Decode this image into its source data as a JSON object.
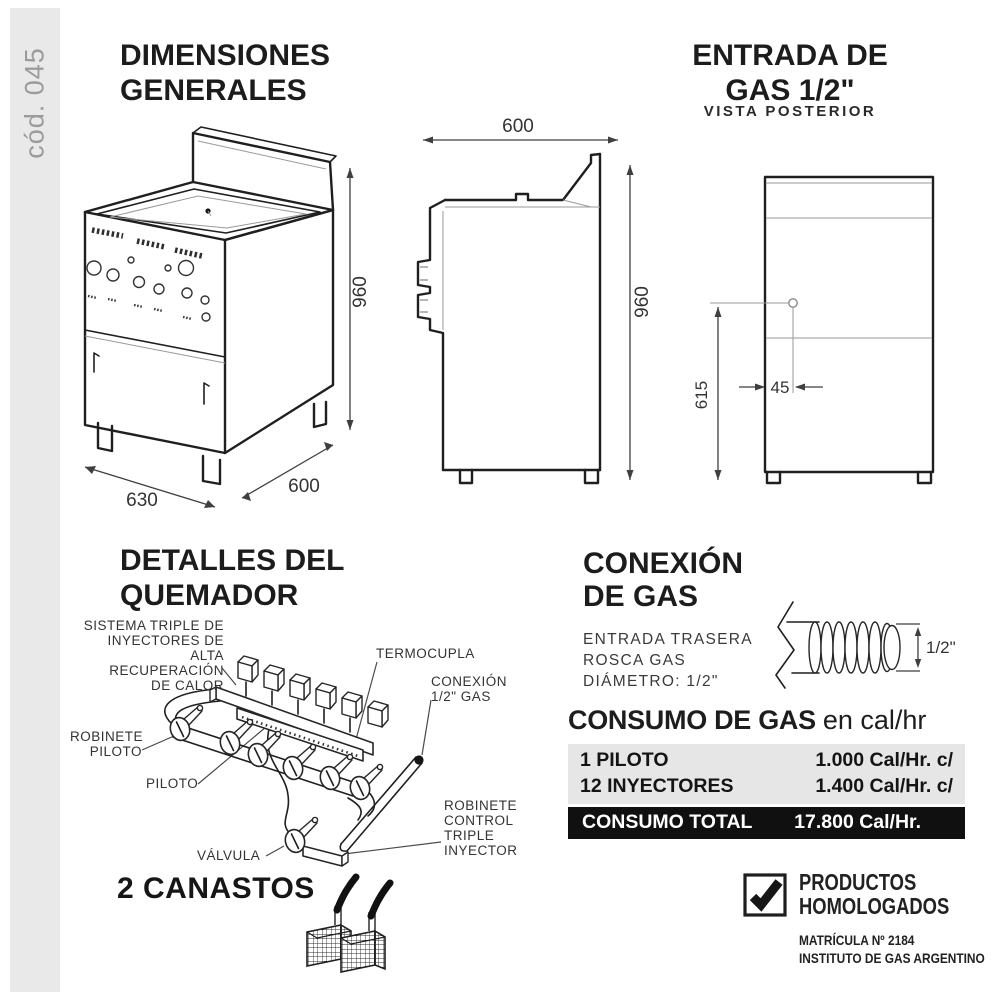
{
  "colors": {
    "sidebar_bg": "#e9e9e9",
    "sidebar_text": "#9b9b9b",
    "line_art": "#1f1f1f",
    "table_gray": "#e6e6e6",
    "table_black": "#101010"
  },
  "sidebar": {
    "code": "cód. 045"
  },
  "dimensiones": {
    "title_line1": "DIMENSIONES",
    "title_line2": "GENERALES",
    "iso_width": "630",
    "iso_depth": "600",
    "iso_height": "960",
    "side_width": "600",
    "side_height": "960"
  },
  "entrada": {
    "title_line1": "ENTRADA DE",
    "title_line2": "GAS 1/2\"",
    "subtitle": "VISTA POSTERIOR",
    "height_dim": "615",
    "offset_dim": "45"
  },
  "quemador": {
    "title_line1": "DETALLES DEL",
    "title_line2": "QUEMADOR",
    "labels": {
      "sistema": "SISTEMA TRIPLE DE\nINYECTORES DE\nALTA RECUPERACIÓN\nDE CALOR",
      "termocupla": "TERMOCUPLA",
      "conexion": "CONEXIÓN\n1/2\" GAS",
      "robinete_piloto": "ROBINETE\nPILOTO",
      "piloto": "PILOTO",
      "valvula": "VÁLVULA",
      "robinete_control": "ROBINETE\nCONTROL\nTRIPLE\nINYECTOR"
    },
    "canastos": "2 CANASTOS"
  },
  "conexion_gas": {
    "title_line1": "CONEXIÓN",
    "title_line2": "DE GAS",
    "desc": "ENTRADA TRASERA\nROSCA GAS\nDIÁMETRO: 1/2\"",
    "pipe_dim": "1/2\""
  },
  "consumo": {
    "title_bold": "CONSUMO DE GAS",
    "title_light": "en cal/hr",
    "rows": [
      {
        "label": "1 PILOTO",
        "value": "1.000 Cal/Hr. c/"
      },
      {
        "label": "12 INYECTORES",
        "value": "1.400 Cal/Hr. c/"
      }
    ],
    "total": {
      "label": "CONSUMO TOTAL",
      "value": "17.800 Cal/Hr."
    }
  },
  "homologados": {
    "line1": "PRODUCTOS",
    "line2": "HOMOLOGADOS",
    "matricula": "MATRÍCULA Nº 2184",
    "instituto": "INSTITUTO DE GAS ARGENTINO"
  }
}
